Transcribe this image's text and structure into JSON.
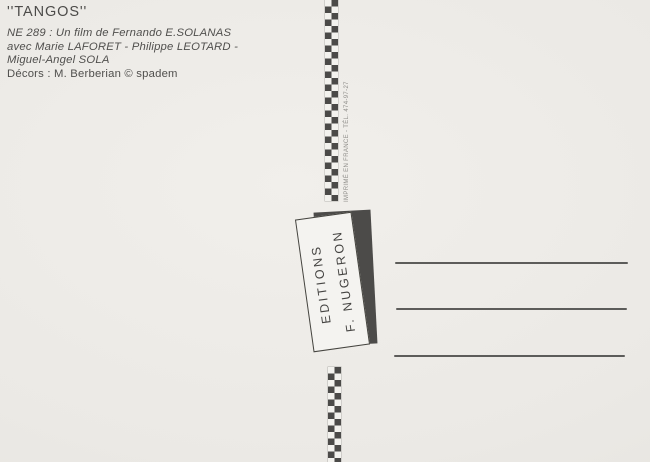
{
  "colors": {
    "paper": "#ebe9e5",
    "ink": "#4c4b49",
    "strip_dark": "#4b4a48",
    "strip_light": "#f3f2ee",
    "stamp_shadow": "#4c4b49",
    "address_line": "#4d4c4a"
  },
  "printed_credits": {
    "title": "''TANGOS''",
    "credit_lines": [
      "NE 289 : Un film de Fernando E.SOLANAS",
      "avec Marie LAFORET - Philippe LEOTARD -",
      "Miguel-Angel SOLA"
    ],
    "decor_line": "Décors : M. Berberian © spadem"
  },
  "publisher_stamp": {
    "line1": "EDITIONS",
    "line2": "F. NUGERON"
  },
  "print_info": "IMPRIMÉ EN FRANCE - TÉL. 474-97-27",
  "address_area": {
    "line_count": 3
  }
}
